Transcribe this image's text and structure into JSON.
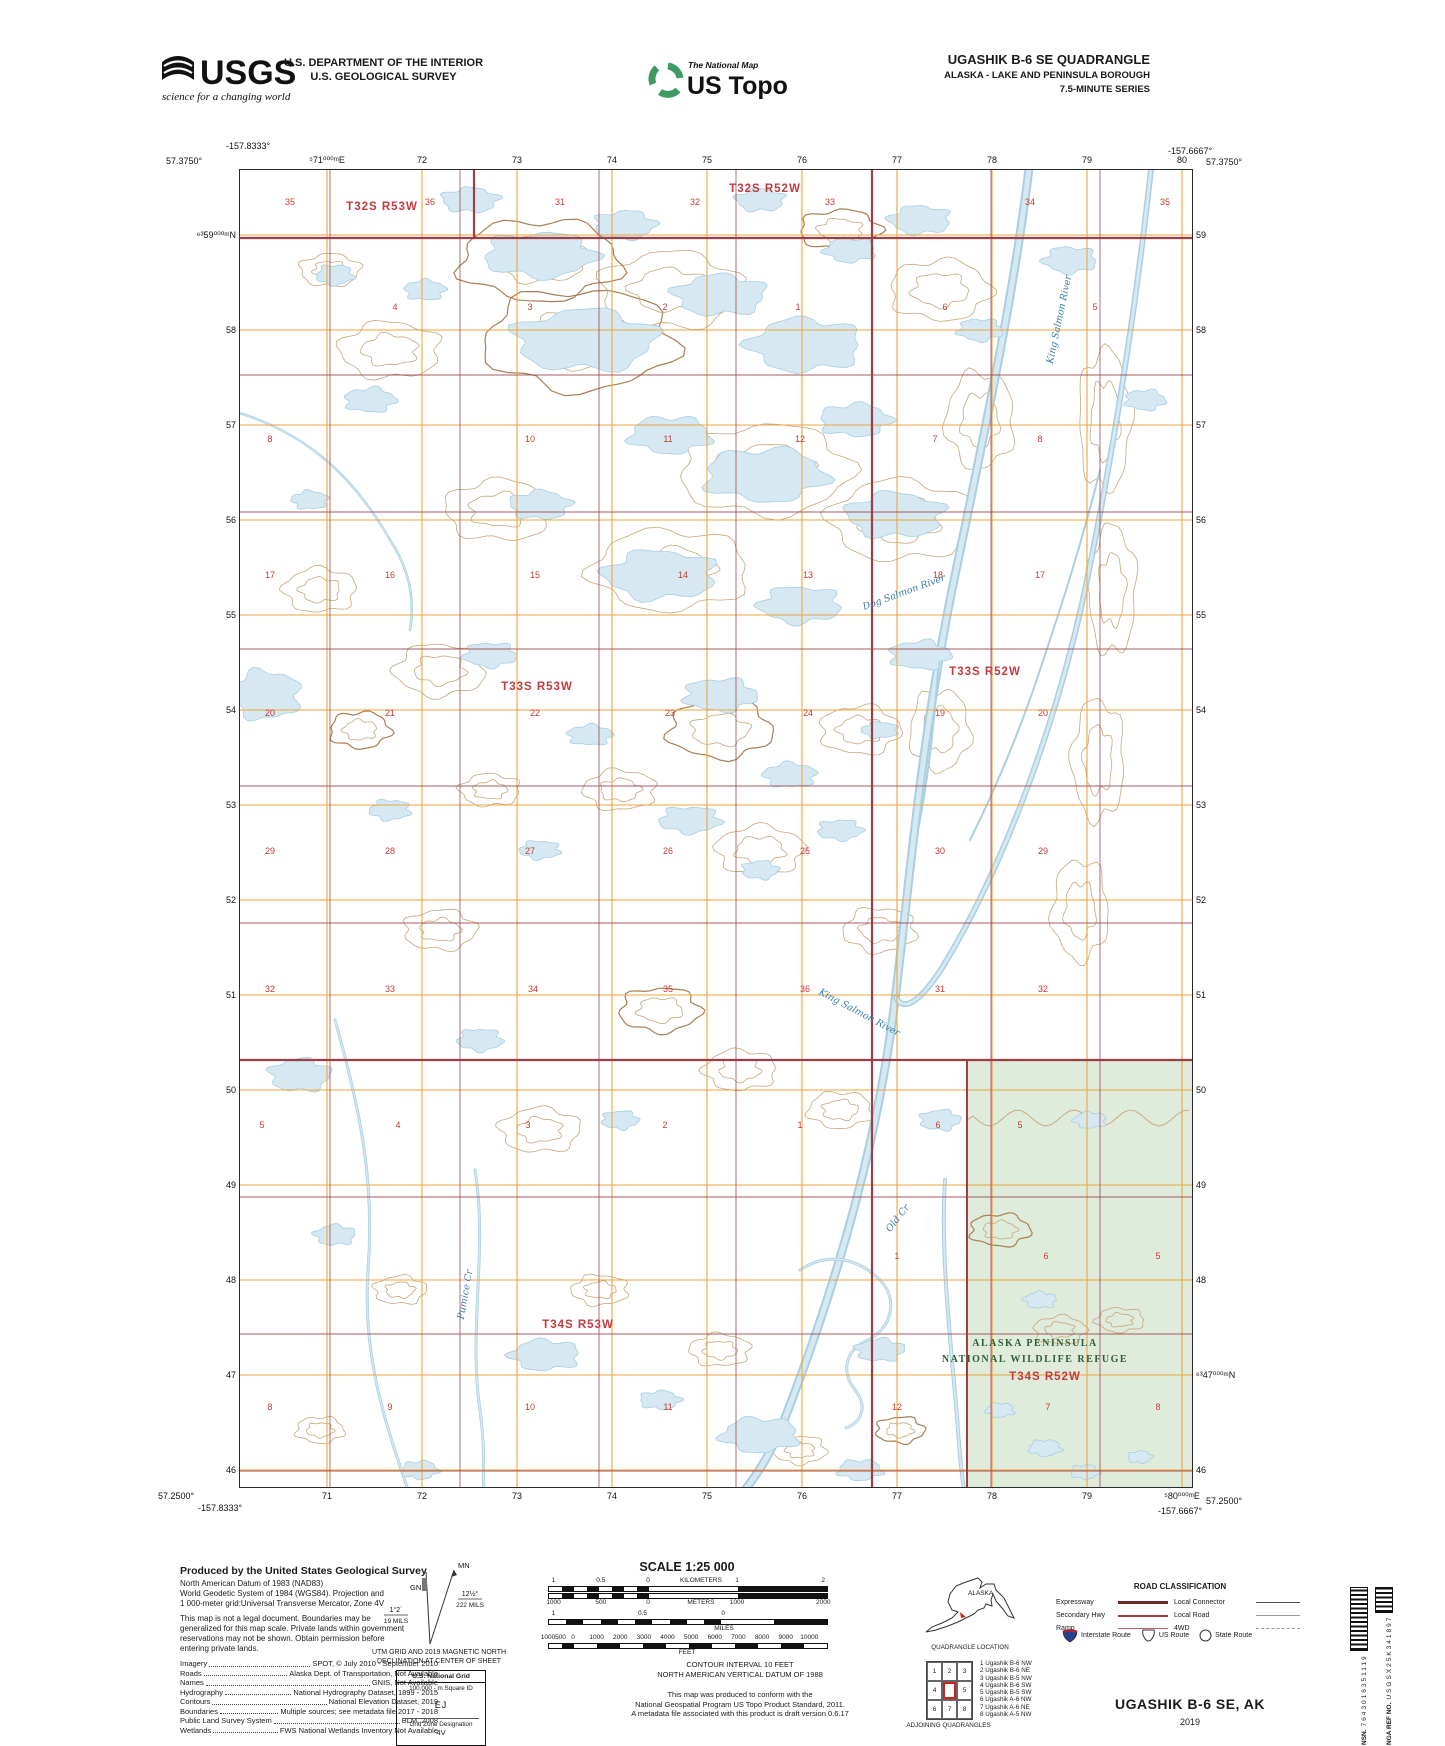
{
  "header": {
    "usgs_logo_text": "USGS",
    "usgs_tagline": "science for a changing world",
    "agency_line1": "U.S. DEPARTMENT OF THE INTERIOR",
    "agency_line2": "U.S. GEOLOGICAL SURVEY",
    "ustopo_brand": "The National Map",
    "ustopo_name": "US Topo",
    "quad_title": "UGASHIK B-6 SE QUADRANGLE",
    "quad_subtitle": "ALASKA - LAKE AND PENINSULA BOROUGH",
    "quad_series": "7.5-MINUTE SERIES"
  },
  "collar": {
    "corner_tl_lat": "57.3750°",
    "corner_tl_lon": "-157.8333°",
    "corner_tr_lat": "57.3750°",
    "corner_tr_lon": "-157.6667°",
    "corner_bl_lat": "57.2500°",
    "corner_bl_lon": "-157.8333°",
    "corner_br_lat": "57.2500°",
    "corner_br_lon": "-157.6667°",
    "top_eastings": [
      "⁵71⁰⁰⁰ᵐE",
      "72",
      "73",
      "74",
      "75",
      "76",
      "77",
      "78",
      "79",
      "80"
    ],
    "bottom_eastings": [
      "71",
      "72",
      "73",
      "74",
      "75",
      "76",
      "77",
      "78",
      "79",
      "⁵80⁰⁰⁰ᵐE"
    ],
    "left_northings": [
      "⁶³59⁰⁰⁰ᵐN",
      "58",
      "57",
      "56",
      "55",
      "54",
      "53",
      "52",
      "51",
      "50",
      "49",
      "48",
      "47",
      "46"
    ],
    "right_northings": [
      "59",
      "58",
      "57",
      "56",
      "55",
      "54",
      "53",
      "52",
      "51",
      "50",
      "49",
      "48",
      "⁶³47⁰⁰⁰ᵐN",
      "46"
    ]
  },
  "map": {
    "townships": [
      {
        "label": "T32S R53W",
        "x": 142,
        "y": 40
      },
      {
        "label": "T32S R52W",
        "x": 525,
        "y": 22
      },
      {
        "label": "T33S R53W",
        "x": 297,
        "y": 520
      },
      {
        "label": "T33S R52W",
        "x": 745,
        "y": 505
      },
      {
        "label": "T34S R53W",
        "x": 338,
        "y": 1158
      },
      {
        "label": "T34S R52W",
        "x": 805,
        "y": 1210
      }
    ],
    "sections": [
      {
        "y": 35,
        "nums": [
          [
            "35",
            50
          ],
          [
            "36",
            190
          ],
          [
            "31",
            320
          ],
          [
            "32",
            455
          ],
          [
            "33",
            590
          ],
          [
            "34",
            790
          ],
          [
            "35",
            925
          ]
        ]
      },
      {
        "y": 140,
        "nums": [
          [
            "4",
            155
          ],
          [
            "3",
            290
          ],
          [
            "2",
            425
          ],
          [
            "1",
            558
          ],
          [
            "6",
            705
          ],
          [
            "5",
            855
          ]
        ]
      },
      {
        "y": 272,
        "nums": [
          [
            "8",
            30
          ],
          [
            "10",
            290
          ],
          [
            "11",
            428
          ],
          [
            "12",
            560
          ],
          [
            "7",
            695
          ],
          [
            "8",
            800
          ]
        ]
      },
      {
        "y": 408,
        "nums": [
          [
            "17",
            30
          ],
          [
            "16",
            150
          ],
          [
            "15",
            295
          ],
          [
            "14",
            443
          ],
          [
            "13",
            568
          ],
          [
            "18",
            698
          ],
          [
            "17",
            800
          ]
        ]
      },
      {
        "y": 546,
        "nums": [
          [
            "20",
            30
          ],
          [
            "21",
            150
          ],
          [
            "22",
            295
          ],
          [
            "23",
            430
          ],
          [
            "24",
            568
          ],
          [
            "19",
            700
          ],
          [
            "20",
            803
          ]
        ]
      },
      {
        "y": 684,
        "nums": [
          [
            "29",
            30
          ],
          [
            "28",
            150
          ],
          [
            "27",
            290
          ],
          [
            "26",
            428
          ],
          [
            "25",
            565
          ],
          [
            "30",
            700
          ],
          [
            "29",
            803
          ]
        ]
      },
      {
        "y": 822,
        "nums": [
          [
            "32",
            30
          ],
          [
            "33",
            150
          ],
          [
            "34",
            293
          ],
          [
            "35",
            428
          ],
          [
            "36",
            565
          ],
          [
            "31",
            700
          ],
          [
            "32",
            803
          ]
        ]
      },
      {
        "y": 958,
        "nums": [
          [
            "5",
            22
          ],
          [
            "4",
            158
          ],
          [
            "3",
            288
          ],
          [
            "2",
            425
          ],
          [
            "1",
            560
          ],
          [
            "6",
            698
          ],
          [
            "5",
            780
          ]
        ]
      },
      {
        "y": 1089,
        "nums": [
          [
            "1",
            657
          ],
          [
            "6",
            806
          ],
          [
            "5",
            918
          ]
        ]
      },
      {
        "y": 1240,
        "nums": [
          [
            "8",
            30
          ],
          [
            "9",
            150
          ],
          [
            "10",
            290
          ],
          [
            "11",
            428
          ],
          [
            "12",
            657
          ],
          [
            "7",
            808
          ],
          [
            "8",
            918
          ]
        ]
      }
    ],
    "water_labels": [
      {
        "label": "King Salmon River",
        "x": 822,
        "y": 150,
        "rot": -78
      },
      {
        "label": "Dog Salmon River",
        "x": 665,
        "y": 425,
        "rot": -20
      },
      {
        "label": "King Salmon River",
        "x": 618,
        "y": 845,
        "rot": 28
      },
      {
        "label": "Old Cr",
        "x": 660,
        "y": 1050,
        "rot": -52
      },
      {
        "label": "Pumice Cr",
        "x": 228,
        "y": 1125,
        "rot": -80
      }
    ],
    "refuge_label_line1": "ALASKA PENINSULA",
    "refuge_label_line2": "NATIONAL WILDLIFE REFUGE",
    "colors": {
      "grid_orange": "#efa53d",
      "plss_red": "#9c3f47",
      "section_red": "#c23b33",
      "township_red": "#c33a40",
      "water_fill": "#d6e8f1",
      "water_stroke": "#a9cfe0",
      "contour": "#c6a77f",
      "contour_index": "#a87f55",
      "refuge_green": "#dfecdb",
      "refuge_text": "#2f5e36",
      "water_text": "#3a7fa8"
    }
  },
  "footer": {
    "produced_title": "Produced by the United States Geological Survey",
    "datum_lines": [
      "North American Datum of 1983 (NAD83)",
      "World Geodetic System of 1984 (WGS84).  Projection and",
      "1 000-meter grid:Universal Transverse Mercator, Zone 4V"
    ],
    "legal_lines": [
      "This map is not a legal document. Boundaries may be",
      "generalized for this map scale. Private lands within government",
      "reservations may not be shown. Obtain permission before",
      "entering private lands."
    ],
    "sources": [
      {
        "a": "Imagery",
        "b": "SPOT, © July 2010 - September 2010"
      },
      {
        "a": "Roads",
        "b": "Alaska Dept. of Transportation, Not Available"
      },
      {
        "a": "Names",
        "b": "GNIS, Not Available"
      },
      {
        "a": "Hydrography",
        "b": "National Hydrography Dataset, 1899 - 2015"
      },
      {
        "a": "Contours",
        "b": "National Elevation Dataset, 2019"
      },
      {
        "a": "Boundaries",
        "b": "Multiple sources; see metadata file 2017 - 2018"
      },
      {
        "a": "Public Land Survey System",
        "b": "BLM, 2008"
      },
      {
        "a": "Wetlands",
        "b": "FWS National Wetlands Inventory Not Available"
      }
    ],
    "declination": {
      "mn": "MN",
      "gn": "GN",
      "mn_deg": "12½°",
      "mn_mils": "222 MILS",
      "gn_deg": "1°2´",
      "gn_mils": "19 MILS",
      "caption1": "UTM GRID AND 2019 MAGNETIC NORTH",
      "caption2": "DECLINATION AT CENTER OF SHEET"
    },
    "usng": {
      "title": "U.S. National Grid",
      "square_label": "100,000 - m Square ID",
      "square": "EJ",
      "zone_label": "Grid Zone Designation",
      "zone": "4V"
    },
    "scale": {
      "title": "SCALE 1:25 000",
      "km_labels": [
        [
          "1",
          2
        ],
        [
          "0.5",
          19
        ],
        [
          "0",
          36
        ],
        [
          "KILOMETERS",
          55
        ],
        [
          "1",
          68
        ],
        [
          "2",
          99
        ]
      ],
      "m_labels": [
        [
          "1000",
          2
        ],
        [
          "500",
          19
        ],
        [
          "0",
          36
        ],
        [
          "METERS",
          55
        ],
        [
          "1000",
          68
        ],
        [
          "2000",
          99
        ]
      ],
      "mi_labels": [
        [
          "1",
          2
        ],
        [
          "0.5",
          34
        ],
        [
          "0",
          63
        ]
      ],
      "mi_caption": "MILES",
      "ft_labels": [
        [
          "1000",
          0
        ],
        [
          "500",
          4.5
        ],
        [
          "0",
          9
        ],
        [
          "1000",
          17.5
        ],
        [
          "2000",
          26
        ],
        [
          "3000",
          34.5
        ],
        [
          "4000",
          43
        ],
        [
          "5000",
          51.5
        ],
        [
          "6000",
          60
        ],
        [
          "7000",
          68.5
        ],
        [
          "8000",
          77
        ],
        [
          "9000",
          85.5
        ],
        [
          "10000",
          94
        ]
      ],
      "ft_caption": "FEET"
    },
    "contour_note1": "CONTOUR INTERVAL 10 FEET",
    "contour_note2": "NORTH AMERICAN VERTICAL DATUM OF 1988",
    "standard_lines": [
      "This map was produced to conform with the",
      "National Geospatial Program US Topo Product Standard, 2011.",
      "A metadata file associated with this product is draft version 0.6.17"
    ],
    "alaska_label": "ALASKA",
    "quadloc_caption": "QUADRANGLE LOCATION",
    "adjoining_caption": "ADJOINING QUADRANGLES",
    "adjoining_cells": [
      "1",
      "2",
      "3",
      "4",
      "",
      "5",
      "6",
      "7",
      "8"
    ],
    "adjoining_list": [
      "1 Ugashik B-6 NW",
      "2 Ugashik B-6 NE",
      "3 Ugashik B-5 NW",
      "4 Ugashik B-6 SW",
      "5 Ugashik B-5 SW",
      "6 Ugashik A-6 NW",
      "7 Ugashik A-6 NE",
      "8 Ugashik A-5 NW"
    ],
    "road_header": "ROAD CLASSIFICATION",
    "road_rows": [
      {
        "l1": "Expressway",
        "c1": "rd-exp",
        "l2": "Local Connector",
        "c2": "rd-lc"
      },
      {
        "l1": "Secondary Hwy",
        "c1": "rd-sec",
        "l2": "Local Road",
        "c2": "rd-lr"
      },
      {
        "l1": "Ramp",
        "c1": "rd-ramp",
        "l2": "4WD",
        "c2": "rd-4wd"
      }
    ],
    "shield_labels": [
      "Interstate Route",
      "US Route",
      "State Route"
    ],
    "sheet_title": "UGASHIK B-6 SE,  AK",
    "sheet_year": "2019",
    "barcode_nsn_label": "NSN.",
    "barcode_nsn": "7643016351119",
    "barcode_nga_label": "NGA REF NO.",
    "barcode_nga": "USGSX25K341897"
  }
}
